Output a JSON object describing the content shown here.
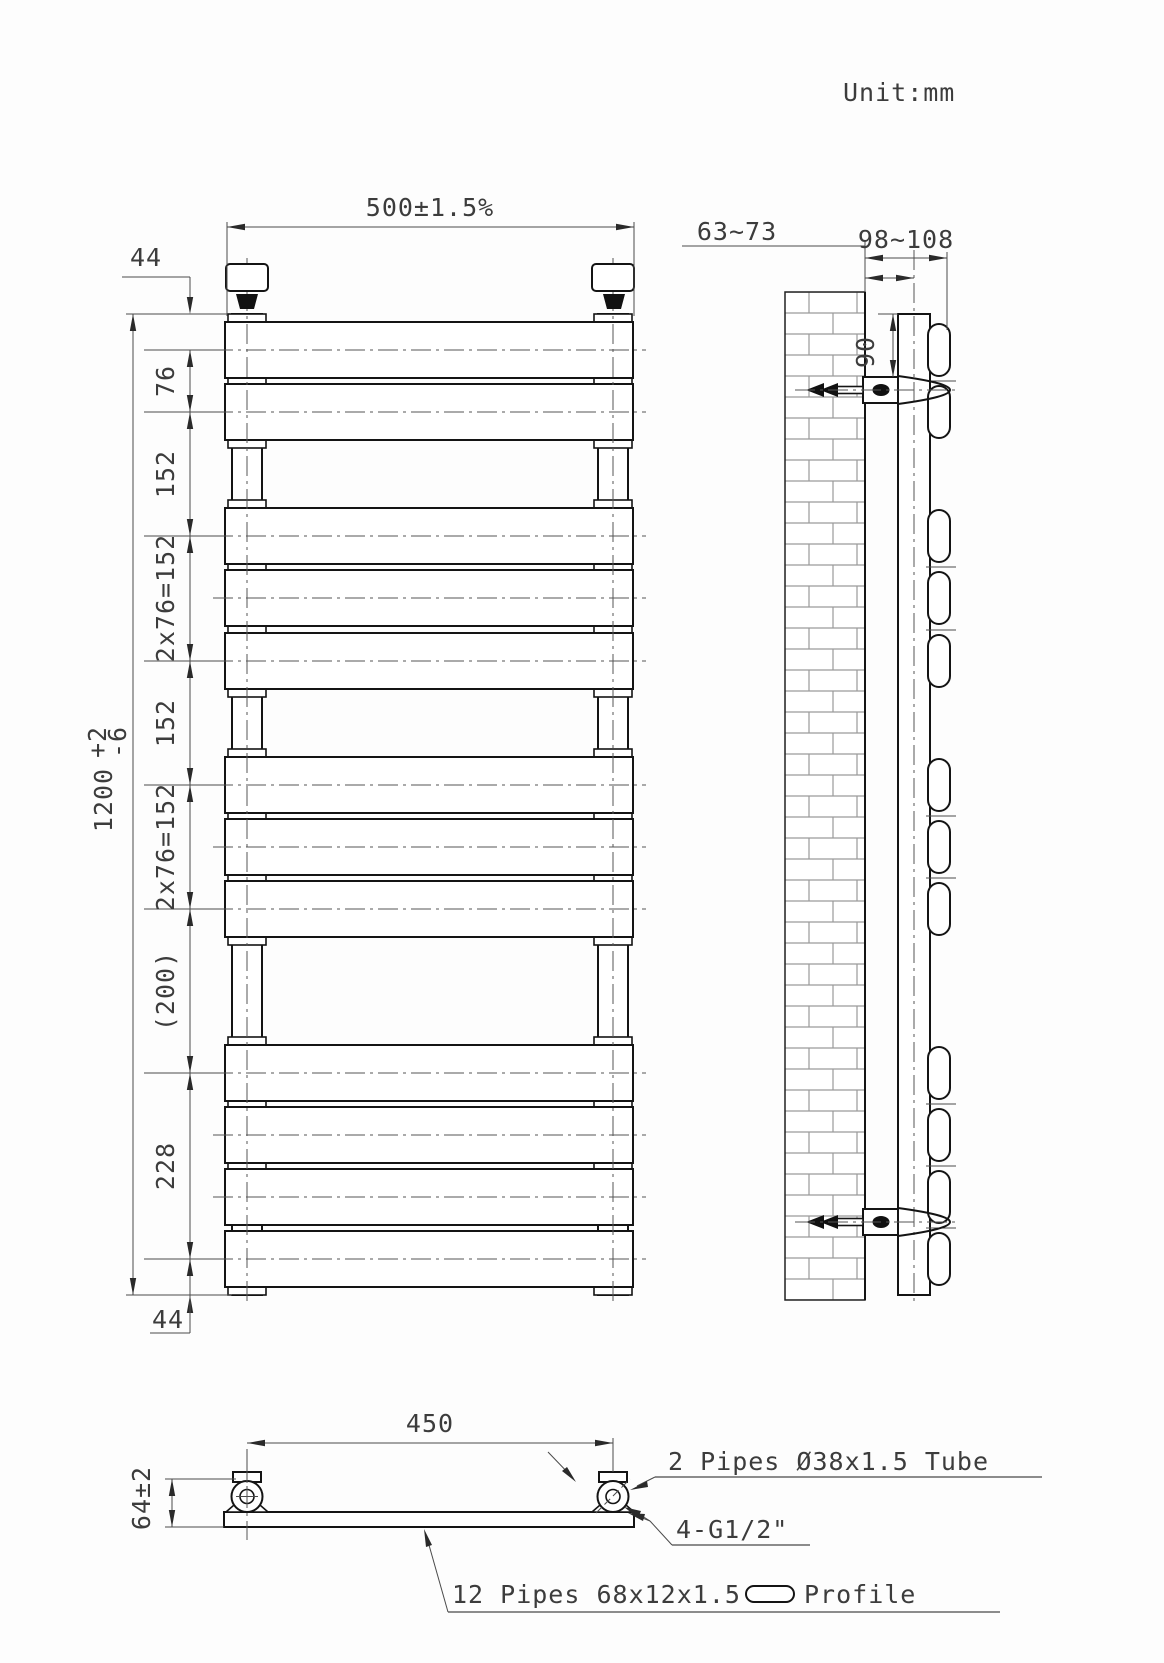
{
  "unit_label": "Unit:mm",
  "front_view": {
    "dim_width": "500±1.5%",
    "dim_top_offset": "44",
    "dim_bottom_offset": "44",
    "dim_height": "1200",
    "dim_height_tol_plus": "+2",
    "dim_height_tol_minus": "-6",
    "chain": {
      "pitch_top": "76",
      "gap_1": "152",
      "group_1": "2x76=152",
      "gap_2": "152",
      "group_2": "2x76=152",
      "gap_3": "(200)",
      "bottom_group": "228"
    }
  },
  "side_view": {
    "dim_wall_to_tube_center": "63~73",
    "dim_wall_to_front": "98~108",
    "dim_bracket_from_top": "90"
  },
  "bottom_view": {
    "dim_tube_spacing": "450",
    "dim_depth": "64±2",
    "note_tubes": "2 Pipes Ø38x1.5 Tube",
    "note_connections": "4-G1/2\"",
    "note_profile_prefix": "12 Pipes 68x12x1.5",
    "note_profile_suffix": "Profile"
  }
}
